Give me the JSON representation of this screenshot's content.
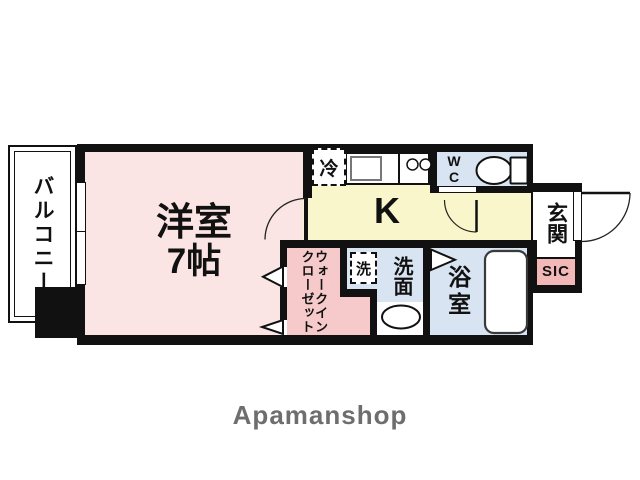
{
  "brand": {
    "logo_text": "Apamanshop"
  },
  "rooms": {
    "balcony": {
      "label": "バルコニー"
    },
    "living": {
      "label": "洋室",
      "size": "7帖"
    },
    "kitchen": {
      "label": "K"
    },
    "wc": {
      "label": "WC"
    },
    "entrance": {
      "label": "玄関"
    },
    "shoe_closet": {
      "label": "SIC"
    },
    "walk_in_closet": {
      "label_col1": "ウォークイン",
      "label_col2": "クローゼット"
    },
    "washroom": {
      "label": "洗面"
    },
    "bathroom": {
      "label": "浴室"
    }
  },
  "fixtures": {
    "refrigerator": {
      "label": "冷"
    },
    "washing_machine": {
      "label": "洗"
    }
  },
  "colors": {
    "wall": "#111111",
    "living_pink": "#fbe4e4",
    "closet_pink": "#f6caca",
    "sic_pink": "#f2b8b8",
    "kitchen_yellow": "#f9f6cb",
    "wet_blue": "#d8e4f1",
    "brand_gray": "#6e6e6e"
  }
}
